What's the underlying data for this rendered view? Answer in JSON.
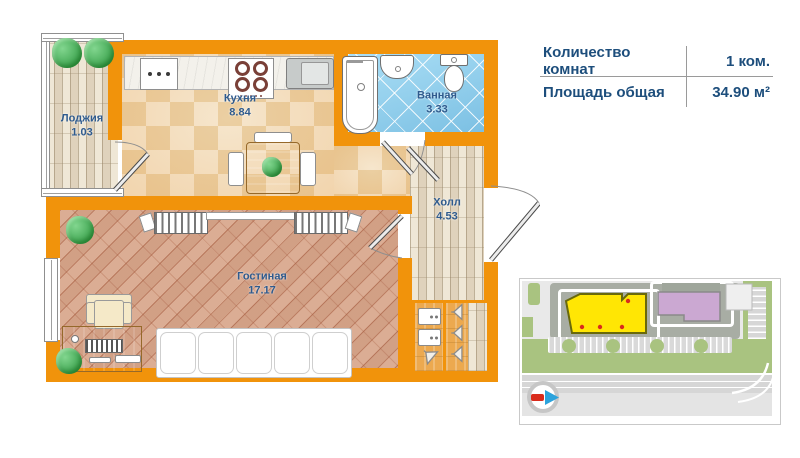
{
  "info_panel": {
    "rows": [
      {
        "label": "Количество комнат",
        "value": "1 ком."
      },
      {
        "label": "Площадь общая",
        "value": "34.90 м²"
      }
    ]
  },
  "floor_plan": {
    "rooms": {
      "loggia": {
        "name": "Лоджия",
        "area": "1.03"
      },
      "kitchen": {
        "name": "Кухня",
        "area": "8.84"
      },
      "bathroom": {
        "name": "Ванная",
        "area": "3.33"
      },
      "hall": {
        "name": "Холл",
        "area": "4.53"
      },
      "living_room": {
        "name": "Гостиная",
        "area": "17.17"
      }
    }
  },
  "colors": {
    "wall": "#F1930B",
    "room-label": "#2F5B8E",
    "info-text": "#1D4E7C",
    "divider": "#9A9A9A",
    "bath-tile": "#8FCDEC",
    "kitchen-tile-light": "#F7EDDA",
    "kitchen-tile-dark": "#EBD4AC",
    "living-floor": "#D9A88D",
    "wood-light": "#EFE7D6",
    "wood-dark": "#DFD2BC",
    "closet-wood": "#ECA94F",
    "site-bg": "#E9E9E9",
    "site-green": "#A9C380",
    "site-dark": "#A8ADA4",
    "site-road": "#D6D6D6",
    "building-highlight": "#FFE604",
    "building-highlight-border": "#69690A",
    "building-secondary": "#CBA8D2",
    "entrance-dot": "#D92B1C",
    "compass-blue": "#2CA3DC",
    "compass-red": "#D92B1C"
  }
}
